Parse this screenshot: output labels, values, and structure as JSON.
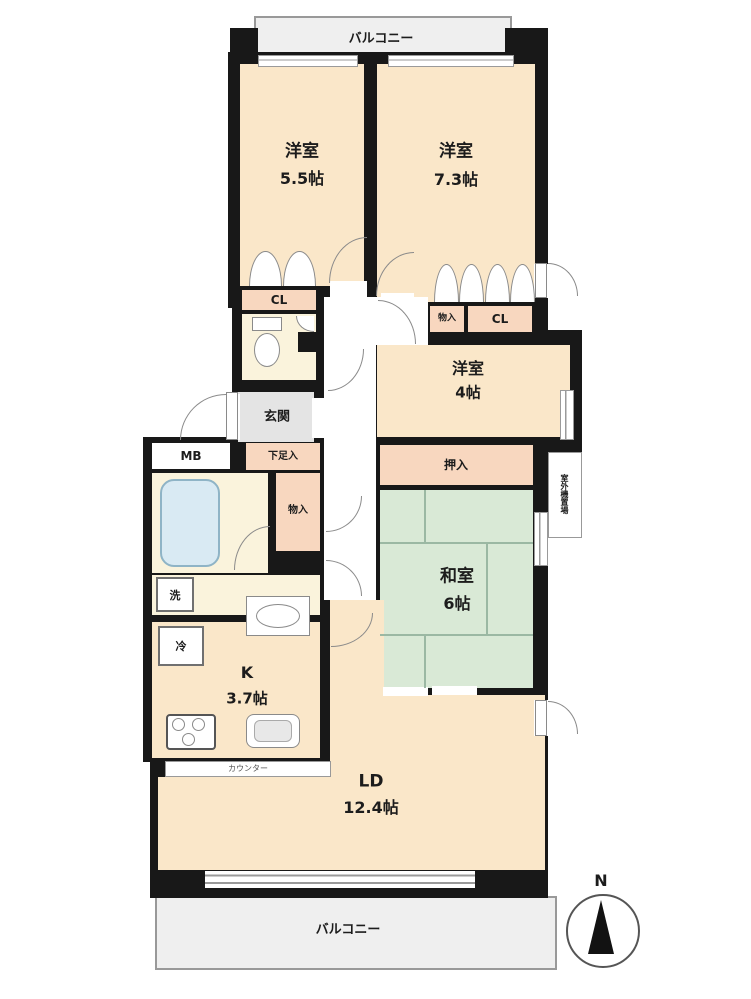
{
  "floorplan": {
    "balcony_top": "バルコニー",
    "balcony_bottom": "バルコニー",
    "rooms": {
      "western_55": {
        "name": "洋室",
        "size": "5.5帖"
      },
      "western_73": {
        "name": "洋室",
        "size": "7.3帖"
      },
      "western_4": {
        "name": "洋室",
        "size": "4帖"
      },
      "japanese_6": {
        "name": "和室",
        "size": "6帖"
      },
      "kitchen": {
        "name": "K",
        "size": "3.7帖"
      },
      "living_dining": {
        "name": "LD",
        "size": "12.4帖"
      }
    },
    "labels": {
      "entrance": "玄関",
      "shoe_cabinet": "下足入",
      "meter_box": "MB",
      "closet_left": "CL",
      "closet_right": "CL",
      "storage_top": "物入",
      "storage_mid": "物入",
      "oshiire": "押入",
      "washer": "洗",
      "refrigerator": "冷",
      "counter": "カウンター",
      "outdoor_unit": "室外機置場"
    },
    "compass": {
      "north": "N"
    },
    "colors": {
      "wall": "#181818",
      "room": "#fae7c9",
      "closet": "#f8d7bf",
      "tatami": "#d9e9d6",
      "entrance_floor": "#e4e4e4",
      "bath_floor": "#faf3dc",
      "bathtub": "#d9eaf3",
      "balcony": "#efefef"
    }
  }
}
